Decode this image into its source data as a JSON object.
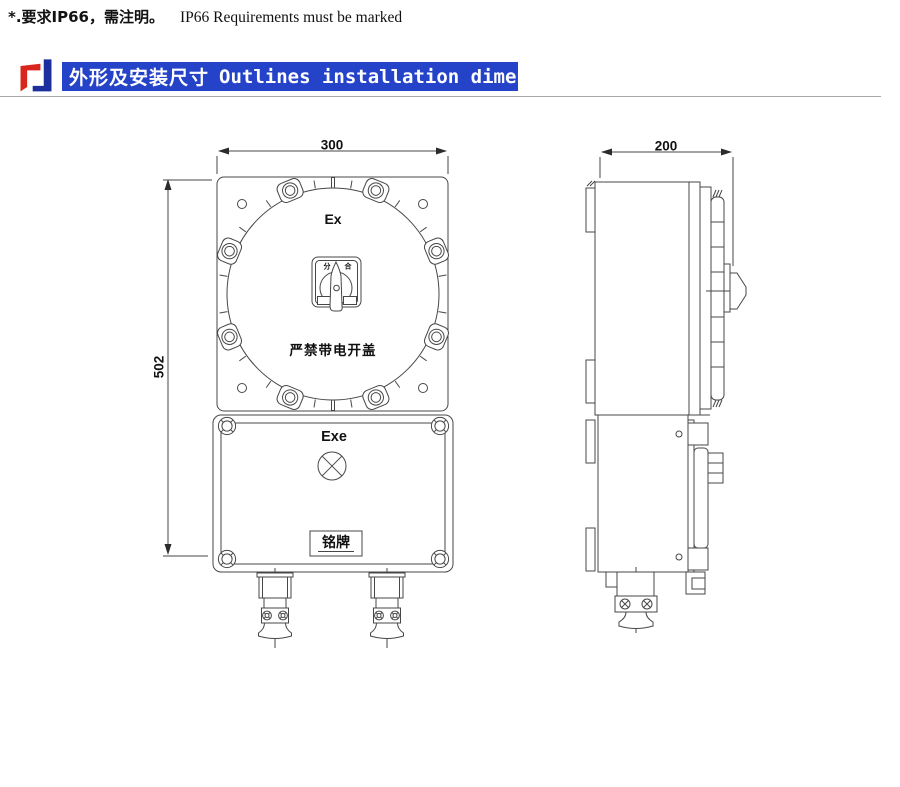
{
  "note": {
    "cn": "*.要求IP66，需注明。",
    "en": "IP66 Requirements must be marked"
  },
  "header": {
    "cn": "外形及安装尺寸",
    "en": "Outlines installation dimensions"
  },
  "front_view": {
    "dim_width": "300",
    "dim_height": "502",
    "cover_marking": "Ex",
    "lower_marking": "Exe",
    "warning": "严禁带电开盖",
    "nameplate": "铭牌",
    "switch_off": "分",
    "switch_on": "合"
  },
  "side_view": {
    "dim_depth": "200"
  },
  "colors": {
    "header_bar": "#2443c9",
    "logo_red": "#d9251c",
    "logo_blue": "#1c2f9c",
    "drawing_line": "#474747",
    "divider": "#a9a9a9"
  }
}
